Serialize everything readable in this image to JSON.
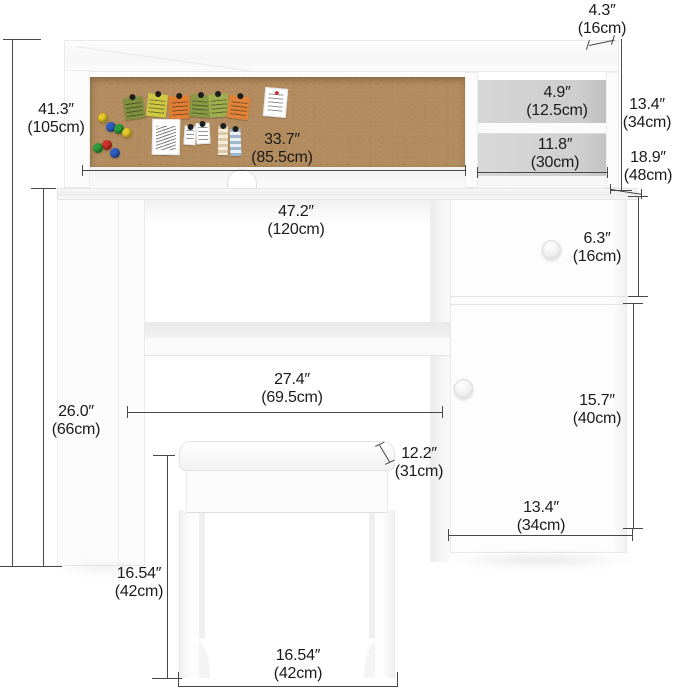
{
  "image_kind": "furniture-dimension-diagram",
  "dims": {
    "hutch_top_depth": {
      "in": "4.3″",
      "cm": "(16cm)"
    },
    "total_height": {
      "in": "41.3″",
      "cm": "(105cm)"
    },
    "corkboard_width": {
      "in": "33.7″",
      "cm": "(85.5cm)"
    },
    "cubby_height": {
      "in": "4.9″",
      "cm": "(12.5cm)"
    },
    "cubby_width": {
      "in": "11.8″",
      "cm": "(30cm)"
    },
    "hutch_height": {
      "in": "13.4″",
      "cm": "(34cm)"
    },
    "desk_depth": {
      "in": "18.9″",
      "cm": "(48cm)"
    },
    "desk_width": {
      "in": "47.2″",
      "cm": "(120cm)"
    },
    "drawer_height": {
      "in": "6.3″",
      "cm": "(16cm)"
    },
    "shelf_width": {
      "in": "27.4″",
      "cm": "(69.5cm)"
    },
    "door_height": {
      "in": "15.7″",
      "cm": "(40cm)"
    },
    "stool_depth": {
      "in": "12.2″",
      "cm": "(31cm)"
    },
    "cabinet_width": {
      "in": "13.4″",
      "cm": "(34cm)"
    },
    "stool_height": {
      "in": "16.54″",
      "cm": "(42cm)"
    },
    "stool_width": {
      "in": "16.54″",
      "cm": "(42cm)"
    },
    "desk_height": {
      "in": "26.0″",
      "cm": "(66cm)"
    }
  },
  "colors": {
    "dimension_line": "#474747",
    "label_text": "#1b1b1b",
    "corkboard": "#b28c5e",
    "cubby_back": "#cfcfcf",
    "furniture_white": "#fcfcfc"
  },
  "board": {
    "note_colors": [
      "#7f8f3f",
      "#cfc843",
      "#e07f33",
      "#8a9a44",
      "#9fae4e",
      "#e08338"
    ],
    "pin_colors": [
      "#e6c727",
      "#2f5fc4",
      "#2e9e3a",
      "#e6c727",
      "#cf3028",
      "#2e9e3a",
      "#2f5fc4"
    ],
    "swatch_beige": "#d9c9a8",
    "swatch_blue": "#9db8cc"
  }
}
